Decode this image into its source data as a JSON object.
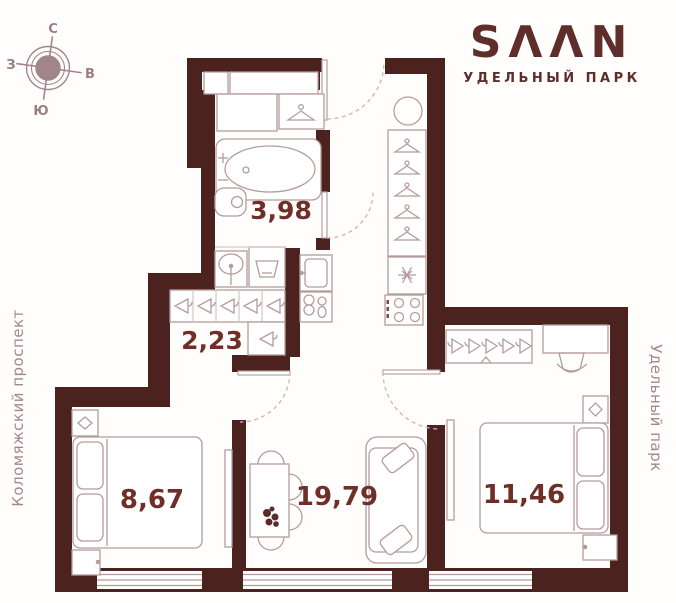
{
  "compass": {
    "north": "С",
    "east": "В",
    "south": "Ю",
    "west": "З"
  },
  "logo": {
    "title": "SΛΛN",
    "subtitle": "УДЕЛЬНЫЙ ПАРК"
  },
  "streets": {
    "left": "Коломяжский проспект",
    "right": "Удельный парк"
  },
  "plan": {
    "rooms": [
      {
        "name": "bathroom",
        "area": "3,98"
      },
      {
        "name": "hallway",
        "area": "2,23"
      },
      {
        "name": "bedroom-left",
        "area": "8,67"
      },
      {
        "name": "living-room",
        "area": "19,79"
      },
      {
        "name": "bedroom-right",
        "area": "11,46"
      }
    ],
    "icons": [
      "compass-rose",
      "hanger-icon",
      "snowflake-icon",
      "stove-burners-icon",
      "plant-icon",
      "bathtub-icon",
      "toilet-icon",
      "sink-icon",
      "washer-icon",
      "bed-icon",
      "sofa-icon",
      "dining-table-icon",
      "desk-chair-icon",
      "boiler-icon"
    ],
    "colors": {
      "wall": "#4b221d",
      "line": "#b59c9c",
      "accent": "#702e29",
      "muted": "#a5878b",
      "logo": "#5f2d2a"
    }
  }
}
